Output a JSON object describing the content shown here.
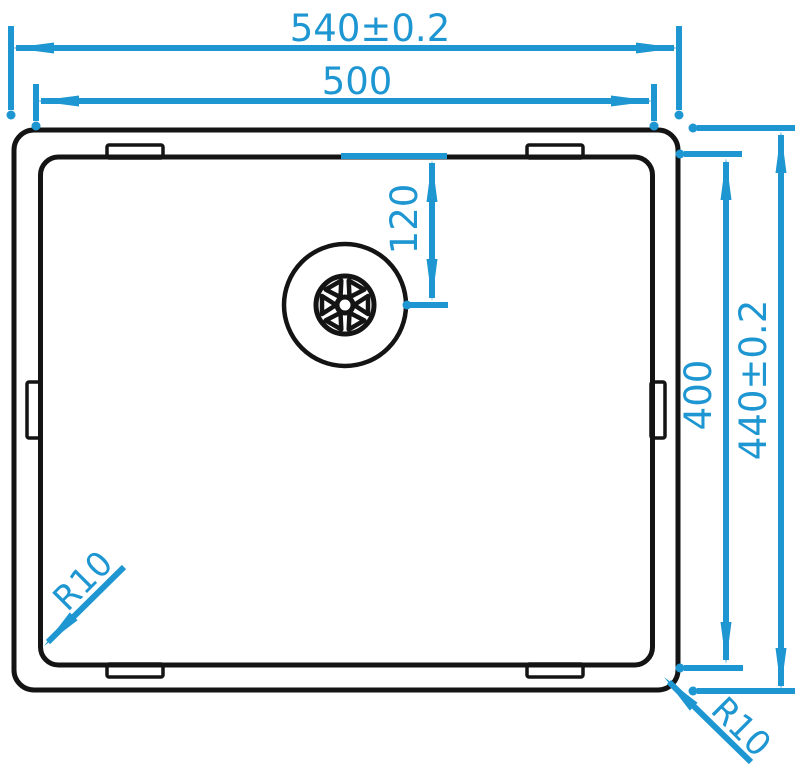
{
  "diagram": {
    "kind": "technical-drawing",
    "subject": "kitchen-sink-top-view",
    "colors": {
      "dimension": "#1e96d2",
      "outline": "#141414",
      "background": "#ffffff"
    },
    "dimensions": {
      "outer_width": {
        "label": "540±0.2",
        "value": 540,
        "tolerance": 0.2
      },
      "inner_width": {
        "label": "500",
        "value": 500
      },
      "drain_offset": {
        "label": "120",
        "value": 120
      },
      "inner_height": {
        "label": "400",
        "value": 400
      },
      "outer_height": {
        "label": "440±0.2",
        "value": 440,
        "tolerance": 0.2
      },
      "bowl_corner_radius": {
        "label": "R10",
        "value": 10
      },
      "rim_corner_radius": {
        "label": "R10",
        "value": 10
      }
    }
  }
}
